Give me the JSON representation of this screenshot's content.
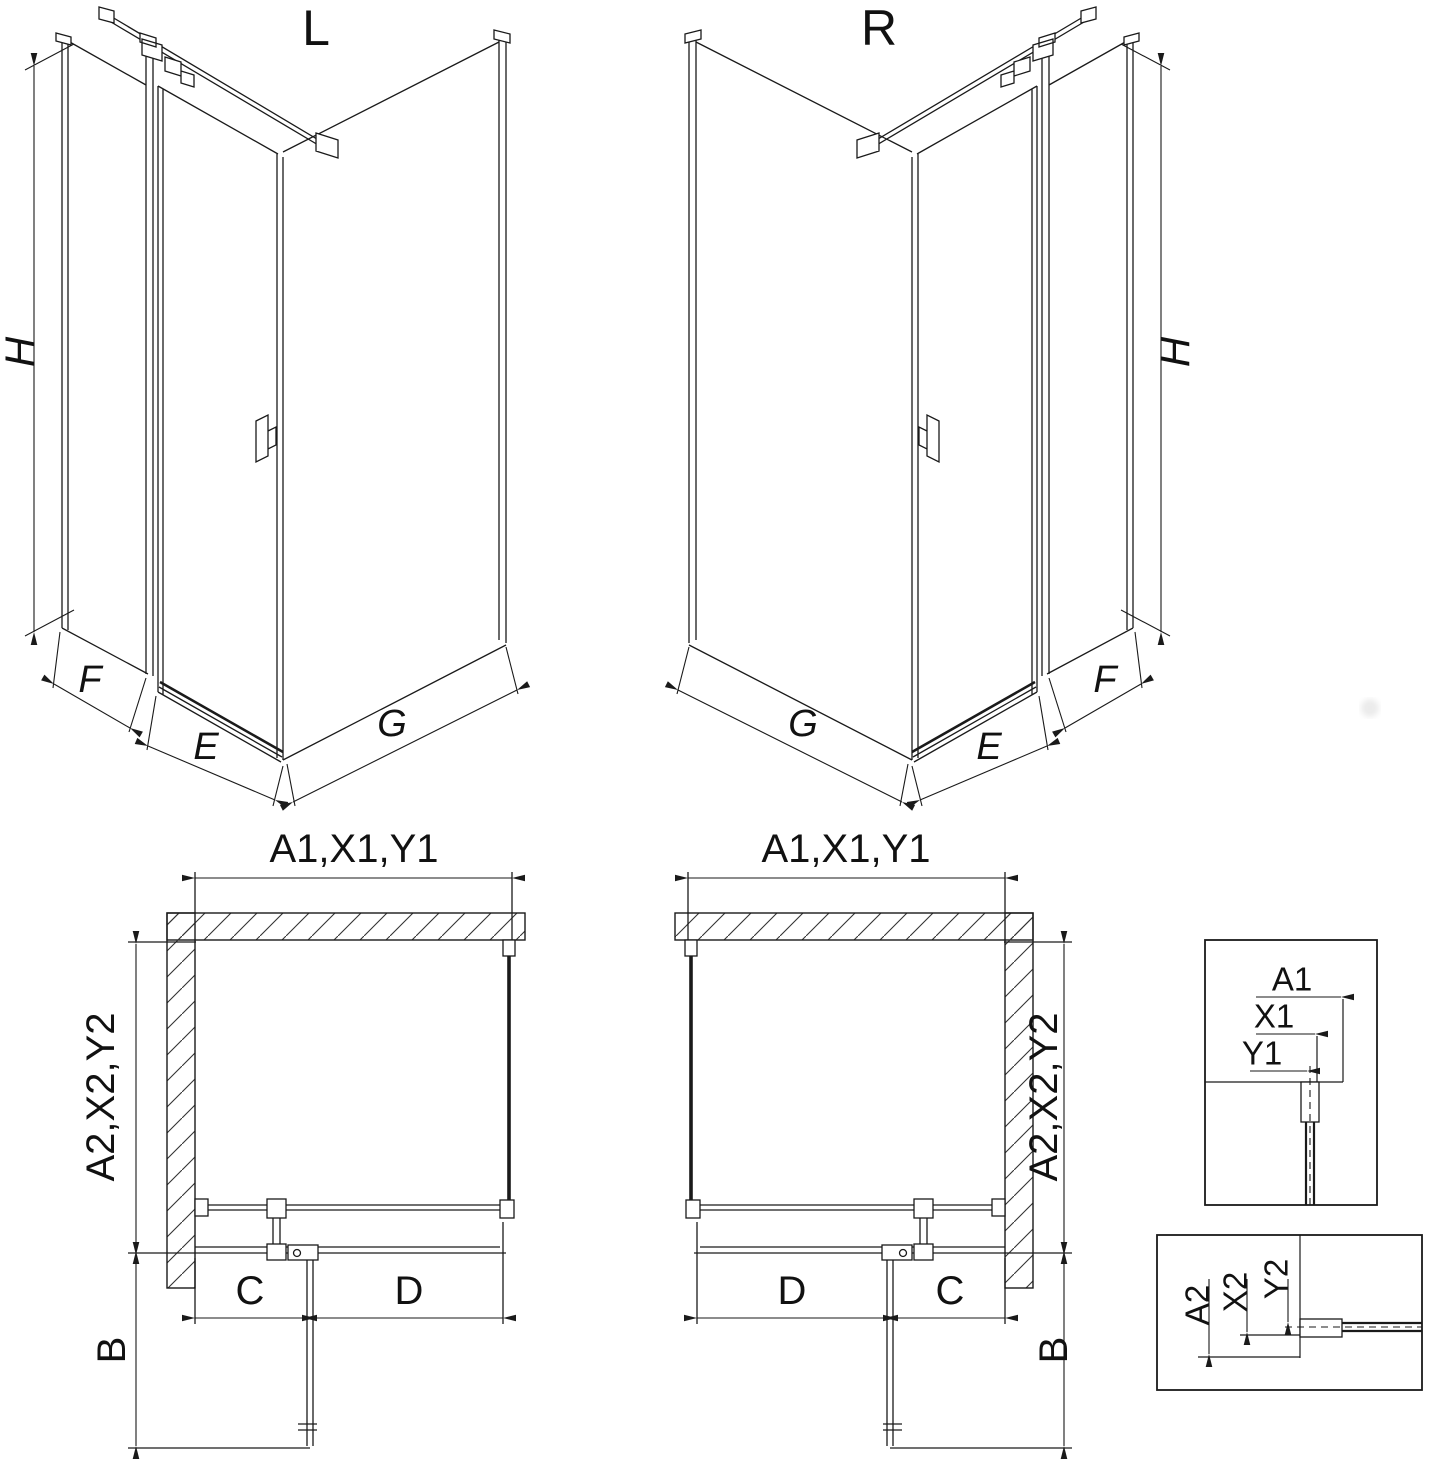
{
  "page": {
    "background": "#ffffff",
    "line_color": "#1a1a1a"
  },
  "iso_views": {
    "left": {
      "title": "L",
      "height_dim": "H",
      "side_panel_dim": "F",
      "door_dim": "E",
      "wall_dim": "G"
    },
    "right": {
      "title": "R",
      "height_dim": "H",
      "side_panel_dim": "F",
      "door_dim": "E",
      "wall_dim": "G"
    }
  },
  "plan_views": {
    "left": {
      "top_dim": "A1,X1,Y1",
      "side_dim": "A2,X2,Y2",
      "swing_dim": "B",
      "fixed_dim": "C",
      "door_dim": "D"
    },
    "right": {
      "top_dim": "A1,X1,Y1",
      "side_dim": "A2,X2,Y2",
      "swing_dim": "B",
      "fixed_dim": "C",
      "door_dim": "D"
    }
  },
  "details": {
    "wall_offset_top": {
      "a": "A1",
      "x": "X1",
      "y": "Y1"
    },
    "wall_offset_side": {
      "a": "A2",
      "x": "X2",
      "y": "Y2"
    }
  }
}
